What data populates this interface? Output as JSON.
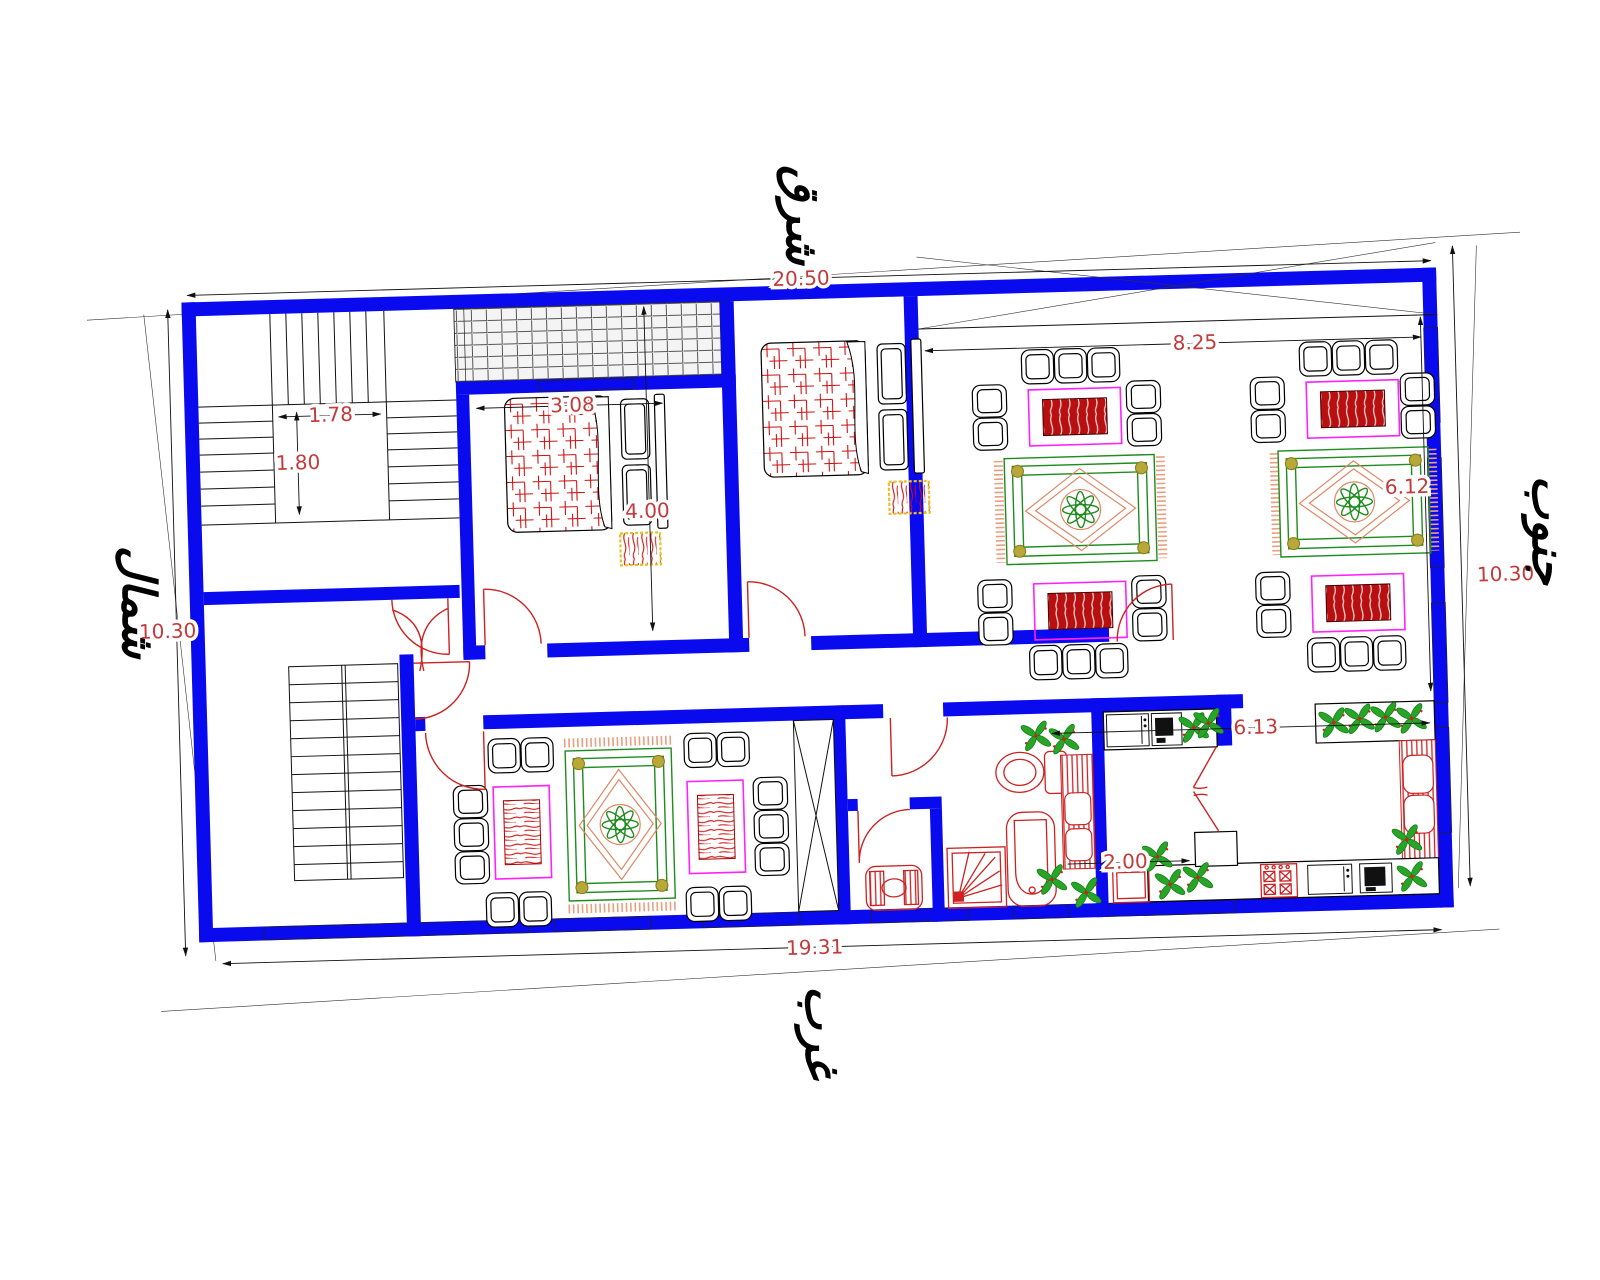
{
  "compass": {
    "east": "شرق",
    "west": "غرب",
    "north": "شمال",
    "south": "جنوب"
  },
  "dimensions": {
    "overall_top": "20.50",
    "overall_bottom": "19.31",
    "overall_left": "10.30",
    "overall_right": "10.30",
    "stairwell_width": "1.78",
    "stairwell_depth": "1.80",
    "bedroom_width": "3.08",
    "bedroom_depth": "4.00",
    "majlis_width": "8.25",
    "majlis_depth": "6.12",
    "kitchen_width": "6.13",
    "kitchen_passage": "2.00"
  },
  "colors": {
    "wall_blue": "#0a0aee",
    "fixture_red": "#cc2222",
    "dimension_text": "#c23a3a",
    "table_frame_magenta": "#ff22ff",
    "carpet_green": "#1e8c1e",
    "carpet_accent_salmon": "#dd8866",
    "plant_green": "#28a428",
    "rug_border_gold": "#e8c020"
  }
}
